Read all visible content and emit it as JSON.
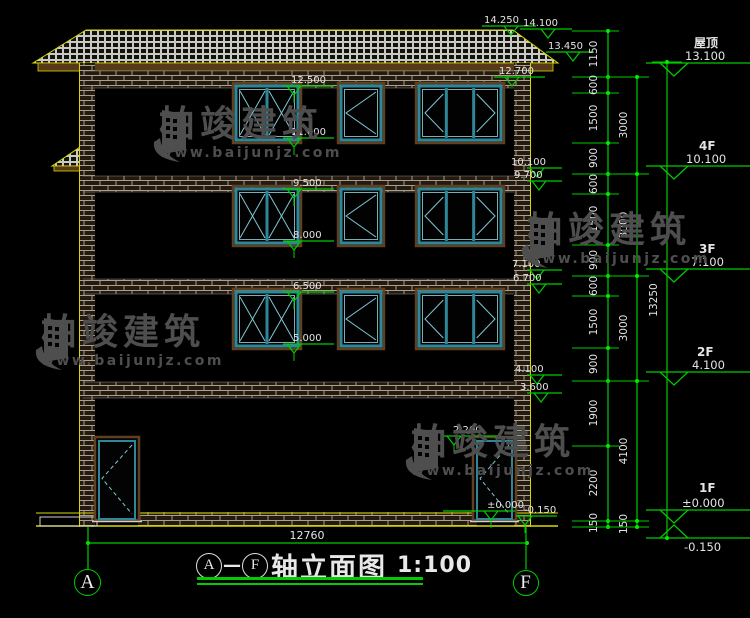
{
  "title_block": {
    "pre": "A",
    "dash": "—",
    "post": "F",
    "text": "轴立面图",
    "scale": "1:100"
  },
  "watermark": {
    "brand": "柏竣建筑",
    "url": "www.baijunjz.com",
    "color": "#4e4e4e",
    "positions": [
      {
        "x": 150,
        "y": 106
      },
      {
        "x": 518,
        "y": 212
      },
      {
        "x": 32,
        "y": 314
      },
      {
        "x": 402,
        "y": 424
      }
    ]
  },
  "axes": [
    {
      "label": "A",
      "cx": 88,
      "cy": 583,
      "r": 14
    },
    {
      "label": "F",
      "cx": 526,
      "cy": 583,
      "r": 13.5
    }
  ],
  "bottom_dim": {
    "label": "12760",
    "x1": 88,
    "x2": 527,
    "y": 543,
    "tx": 307,
    "ty": 539
  },
  "levels": {
    "top": [
      {
        "label": "14.250",
        "x1": 482,
        "x2": 536,
        "y": 26,
        "tri": 504,
        "tx": 484
      },
      {
        "label": "14.100",
        "x1": 520,
        "x2": 572,
        "y": 29,
        "tri": 541,
        "tx": 523
      },
      {
        "label": "13.450",
        "x1": 546,
        "x2": 594,
        "y": 52,
        "tri": 566,
        "tx": 548
      },
      {
        "label": "12.700",
        "x1": 494,
        "x2": 545,
        "y": 77,
        "tri": 505,
        "tx": 499
      }
    ],
    "interior": [
      {
        "label": "12.500",
        "x1": 283,
        "x2": 334,
        "y": 86,
        "tri": 287,
        "tx": 291
      },
      {
        "label": "11.000",
        "x1": 283,
        "x2": 334,
        "y": 138,
        "tri": 287,
        "tx": 291
      },
      {
        "label": "9.500",
        "x1": 283,
        "x2": 334,
        "y": 189,
        "tri": 287,
        "tx": 293
      },
      {
        "label": "8.000",
        "x1": 283,
        "x2": 334,
        "y": 241,
        "tri": 287,
        "tx": 293
      },
      {
        "label": "6.500",
        "x1": 283,
        "x2": 334,
        "y": 292,
        "tri": 287,
        "tx": 293
      },
      {
        "label": "5.000",
        "x1": 283,
        "x2": 334,
        "y": 344,
        "tri": 287,
        "tx": 293
      },
      {
        "label": "2.200",
        "x1": 443,
        "x2": 500,
        "y": 436,
        "tri": 447,
        "tx": 453
      },
      {
        "label": "±0.000",
        "x1": 443,
        "x2": 515,
        "y": 511,
        "tri": 484,
        "tx": 487
      },
      {
        "label": "-0.150",
        "x1": 516,
        "x2": 557,
        "y": 516,
        "tri": 518,
        "tx": 524
      }
    ],
    "right_edge": [
      {
        "label": "10.100",
        "x1": 527,
        "x2": 562,
        "y": 168,
        "tri": 530,
        "tx": 511
      },
      {
        "label": "9.700",
        "x1": 527,
        "x2": 562,
        "y": 181,
        "tri": 532,
        "tx": 514
      },
      {
        "label": "7.100",
        "x1": 527,
        "x2": 562,
        "y": 270,
        "tri": 530,
        "tx": 512
      },
      {
        "label": "6.700",
        "x1": 527,
        "x2": 562,
        "y": 284,
        "tri": 532,
        "tx": 513
      },
      {
        "label": "4.100",
        "x1": 527,
        "x2": 562,
        "y": 375,
        "tri": 530,
        "tx": 515
      },
      {
        "label": "3.600",
        "x1": 527,
        "x2": 562,
        "y": 393,
        "tri": 534,
        "tx": 520
      }
    ]
  },
  "floor_labels": [
    {
      "name": "屋顶",
      "elev": "13.100",
      "nx": 694,
      "ny": 47,
      "ex": 685,
      "ey": 60,
      "line_y": 63,
      "dir": "down"
    },
    {
      "name": "4F",
      "elev": "10.100",
      "nx": 699,
      "ny": 150,
      "ex": 686,
      "ey": 163,
      "line_y": 166,
      "dir": "down"
    },
    {
      "name": "3F",
      "elev": "7.100",
      "nx": 699,
      "ny": 253,
      "ex": 691,
      "ey": 266,
      "line_y": 269,
      "dir": "down"
    },
    {
      "name": "2F",
      "elev": "4.100",
      "nx": 697,
      "ny": 356,
      "ex": 692,
      "ey": 369,
      "line_y": 372,
      "dir": "down"
    },
    {
      "name": "1F",
      "elev": "±0.000",
      "nx": 699,
      "ny": 492,
      "ex": 682,
      "ey": 507,
      "line_y": 510,
      "dir": "down"
    },
    {
      "name": "",
      "elev": "-0.150",
      "nx": 0,
      "ny": 0,
      "ex": 684,
      "ey": 551,
      "line_y": 538,
      "dir": "up"
    }
  ],
  "dim_chains": {
    "chain1": {
      "x": 608,
      "y1": 31,
      "y2": 527,
      "tick_x1": 572,
      "tick_x2": 619,
      "label_x": 597,
      "ticks": [
        31,
        77,
        93,
        143,
        174,
        194,
        245,
        276,
        296,
        348,
        381,
        446,
        521,
        527
      ],
      "segments": [
        {
          "label": "1150",
          "y": 54
        },
        {
          "label": "600",
          "y": 85
        },
        {
          "label": "1500",
          "y": 118
        },
        {
          "label": "900",
          "y": 158
        },
        {
          "label": "600",
          "y": 184
        },
        {
          "label": "1500",
          "y": 219
        },
        {
          "label": "900",
          "y": 260
        },
        {
          "label": "600",
          "y": 286
        },
        {
          "label": "1500",
          "y": 322
        },
        {
          "label": "900",
          "y": 364
        },
        {
          "label": "1900",
          "y": 413
        },
        {
          "label": "2200",
          "y": 483
        },
        {
          "label": "150",
          "y": 523
        }
      ]
    },
    "chain2": {
      "x": 637,
      "y1": 77,
      "y2": 527,
      "tick_x1": 598,
      "tick_x2": 649,
      "label_x": 627,
      "ticks": [
        77,
        174,
        276,
        381,
        521,
        527
      ],
      "segments": [
        {
          "label": "3000",
          "y": 125
        },
        {
          "label": "3000",
          "y": 225
        },
        {
          "label": "3000",
          "y": 328
        },
        {
          "label": "4100",
          "y": 451
        },
        {
          "label": "150",
          "y": 524
        }
      ]
    },
    "chain3": {
      "x": 667,
      "y1": 62,
      "y2": 538,
      "tick_x1": 652,
      "tick_x2": 682,
      "label_x": 657,
      "ticks": [
        62,
        538
      ],
      "segments": [
        {
          "label": "13250",
          "y": 300
        }
      ]
    }
  },
  "building": {
    "roof": {
      "pts": "33,63 86,30 513,30 558,63"
    },
    "fascia": {
      "x": 38,
      "y": 63,
      "w": 515,
      "h": 8
    },
    "awning": {
      "pts": "52,166 86,143 86,166",
      "fx": 54,
      "fy": 166,
      "fw": 34,
      "fh": 5
    },
    "piers": [
      {
        "x": 79,
        "w": 16
      },
      {
        "x": 514,
        "w": 16
      }
    ],
    "pier_y": 63,
    "pier_h": 464,
    "yellow_lines_x": [
      79.5,
      530.5
    ],
    "bands": [
      {
        "y": 71,
        "h": 17
      },
      {
        "y": 176,
        "h": 16
      },
      {
        "y": 279,
        "h": 15
      },
      {
        "y": 382,
        "h": 16
      }
    ],
    "band_x": 83,
    "band_w": 431,
    "plinth": {
      "x": 138,
      "y": 512,
      "w": 339,
      "h": 14
    },
    "ground": {
      "x1": 36,
      "x2": 558,
      "y1": 513,
      "y2": 526
    },
    "platform": {
      "x": 40,
      "y": 517,
      "w": 57,
      "h": 9
    },
    "floors": [
      {
        "y": 86
      },
      {
        "y": 189
      },
      {
        "y": 292
      }
    ],
    "window_h": 54,
    "windows": [
      {
        "type": "double",
        "x": 236,
        "w": 62
      },
      {
        "type": "single",
        "x": 341,
        "w": 40
      },
      {
        "type": "triple",
        "x": 419,
        "w": 82
      }
    ],
    "doors": {
      "y": 437,
      "h": 83,
      "items": [
        {
          "x": 95,
          "w": 44
        },
        {
          "x": 473,
          "w": 43
        }
      ]
    }
  },
  "colors": {
    "green": "#00cc00",
    "bright_green": "#00ee00",
    "yellow": "#d8d800",
    "white": "#e4e4e4",
    "teal": "#2e8799",
    "teal_light": "#7fc8d4",
    "teal_pale": "#9fd8e0",
    "brown": "#6b4a28",
    "fascia": "#573818",
    "brick_bg": "#241a10",
    "mortar": "#b0a896",
    "tile_bg": "#131308",
    "tile_line": "#c9c9c9",
    "watermark": "#4e4e4e"
  }
}
